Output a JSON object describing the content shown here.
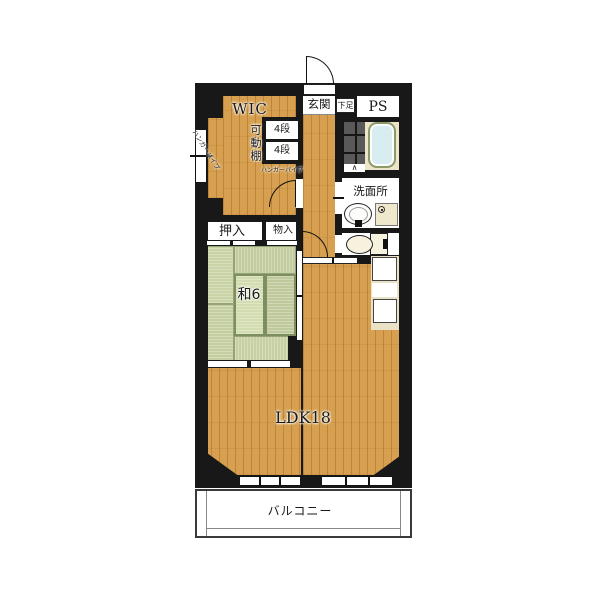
{
  "plan_title": "apartment-floor-plan",
  "rooms": {
    "wic": {
      "label": "WIC"
    },
    "shelf_unit": {
      "label": "可動棚",
      "tiers": [
        "4段",
        "4段"
      ],
      "hanger_pipe_side": "ハンガーパイプ",
      "hanger_pipe_bottom": "ハンガーパイプ"
    },
    "genkan": {
      "label": "玄関",
      "shoe_box": "下足"
    },
    "ps": {
      "label": "PS"
    },
    "washroom": {
      "label": "洗面所"
    },
    "oshiire": {
      "label": "押入"
    },
    "monoire": {
      "label": "物入"
    },
    "washitsu": {
      "label": "和6"
    },
    "ldk": {
      "label": "LDK18"
    },
    "balcony": {
      "label": "バルコニー"
    }
  },
  "icons": {
    "folding_door": "∧"
  },
  "colors": {
    "wall": "#181818",
    "wood_floor": "#d6a050",
    "tatami": "#c6d0a2",
    "bathtub": "#d7edef",
    "bath_tile": "#595959",
    "fixture_cream": "#efe8cc",
    "label_text": "#1a1a1a"
  }
}
